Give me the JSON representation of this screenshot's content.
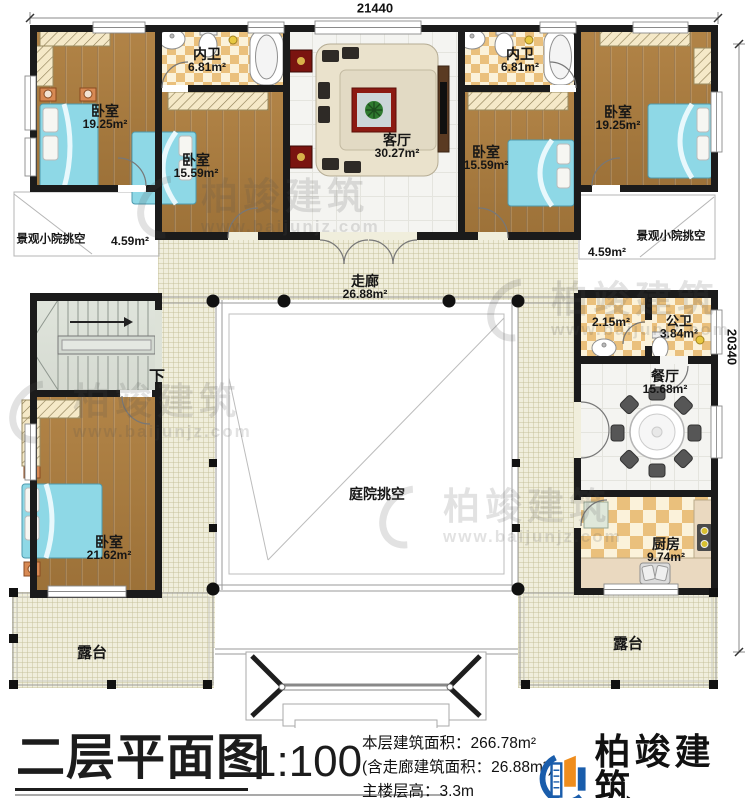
{
  "plan": {
    "dim_top": "21440",
    "dim_right": "20340",
    "stairs_label": "下"
  },
  "rooms": {
    "bedroom_tl": {
      "name": "卧室",
      "area": "19.25m²"
    },
    "bathroom_tl": {
      "name": "内卫",
      "area": "6.81m²"
    },
    "bedroom_tl2": {
      "name": "卧室",
      "area": "15.59m²"
    },
    "living": {
      "name": "客厅",
      "area": "30.27m²"
    },
    "bathroom_tr": {
      "name": "内卫",
      "area": "6.81m²"
    },
    "bedroom_tr2": {
      "name": "卧室",
      "area": "15.59m²"
    },
    "bedroom_tr": {
      "name": "卧室",
      "area": "19.25m²"
    },
    "void_left": {
      "name": "景观小院挑空",
      "area": "4.59m²"
    },
    "void_right": {
      "name": "景观小院挑空",
      "area": "4.59m²"
    },
    "corridor": {
      "name": "走廊",
      "area": "26.88m²"
    },
    "utility": {
      "area": "2.15m²"
    },
    "public_bath": {
      "name": "公卫",
      "area": "3.84m²"
    },
    "dining": {
      "name": "餐厅",
      "area": "15.68m²"
    },
    "courtyard": {
      "name": "庭院挑空"
    },
    "bedroom_bl": {
      "name": "卧室",
      "area": "21.62m²"
    },
    "kitchen": {
      "name": "厨房",
      "area": "9.74m²"
    },
    "terrace_left": {
      "name": "露台"
    },
    "terrace_right": {
      "name": "露台"
    }
  },
  "watermark": {
    "brand": "柏竣建筑",
    "url": "www.baijunjz.com"
  },
  "footer": {
    "title": "二层平面图",
    "scale": "1:100",
    "stats": [
      "本层建筑面积：266.78m²",
      "(含走廊建筑面积：26.88m²)",
      "主楼层高：3.3m"
    ],
    "logo": {
      "brand": "柏竣建筑",
      "url": "www.baijunjz.com"
    }
  },
  "colors": {
    "wall": "#1b1b1b",
    "wood_floor": "#a97c3f",
    "bed_blue": "#8ed8e6",
    "checker_tan": "#eac07c",
    "floor_cream": "#f0eedc",
    "logo_blue": "#1a5dab",
    "logo_orange": "#ef8d1d"
  }
}
